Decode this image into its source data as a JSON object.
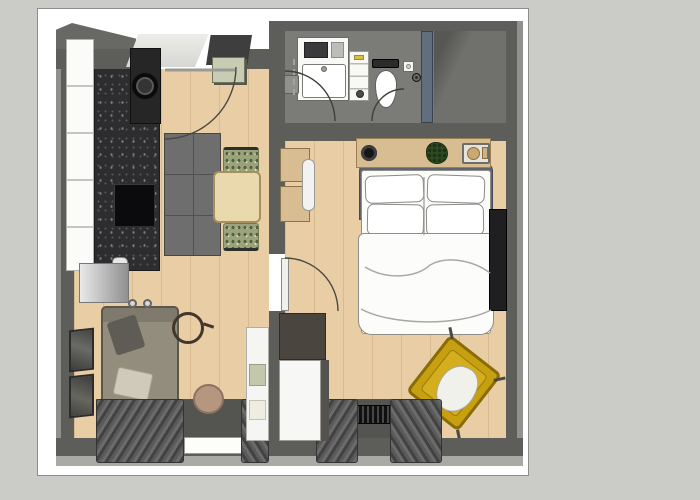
{
  "scene": {
    "type": "apartment-floor-plan-3d-top-view",
    "rooms": [
      {
        "name": "living-room-kitchen",
        "floor": "wood"
      },
      {
        "name": "bathroom",
        "floor": "gray"
      },
      {
        "name": "bedroom",
        "floor": "wood"
      }
    ],
    "living_room_items": [
      "entry-landing-mat",
      "dark-doormat",
      "shoe-cabinet",
      "washing-machine-tower",
      "kitchen-cabinet-run",
      "granite-countertop",
      "cooktop",
      "kitchen-sink",
      "refrigerator",
      "area-rug",
      "dining-table",
      "dining-chair-top",
      "dining-chair-bottom",
      "sofa",
      "throw-pillow",
      "throw-blanket",
      "wall-art-frames",
      "round-ring-decor",
      "pouf",
      "shelving-unit",
      "window-sill",
      "curtains",
      "door-swing"
    ],
    "bathroom_items": [
      "vanity-with-sink",
      "storage-drawers",
      "toilet",
      "toilet-paper-holder",
      "shower-glass-panel",
      "shower-head",
      "waste-bin",
      "door-swings"
    ],
    "bedroom_items": [
      "wall-desk-boxes",
      "desk-chair",
      "floating-shelf",
      "speaker",
      "plant",
      "decor-tray",
      "double-bed",
      "headboard",
      "pillows",
      "duvet",
      "tv-panel",
      "dark-cabinet",
      "white-dresser",
      "yellow-armchair",
      "white-throw",
      "radiator",
      "curtains",
      "door-swing"
    ]
  },
  "palette": {
    "page_bg": "#cbccc8",
    "card_bg": "#ffffff",
    "card_border": "#8e8e8a",
    "wall": "#5d5d59",
    "wall_light": "#a9a9a5",
    "wood": "#e9cda5",
    "bath_floor": "#7b7b77",
    "shower_floor": "#70706c",
    "rug": "#6e6e6e",
    "granite": "#2d2d2f",
    "white_obj": "#f8f8f6",
    "glass": "#5d6c7e",
    "headboard": "#5e6570",
    "bedding": "#fbfbfa",
    "shelf_wood": "#d9bd92",
    "chair_fabric": "#9ba37d",
    "table_wood": "#ead9ad",
    "sofa": "#928d7d",
    "sofa_back": "#7f7a6c",
    "yellow": "#c7a011",
    "yellow_dark": "#8a6c06",
    "pouf": "#b5967f",
    "mint_box": "#c8ccb2",
    "curtain": "#5a5a5a",
    "radiator": "#1c1c1c",
    "silver": "#e9e9e9",
    "silver_dark": "#8f8f8f",
    "tv": "#1f1f22",
    "frame_art": "#4a4a4a",
    "dresser_dark": "#4a453f",
    "plant": "#2f4a23",
    "arc": "#4a4a42"
  }
}
